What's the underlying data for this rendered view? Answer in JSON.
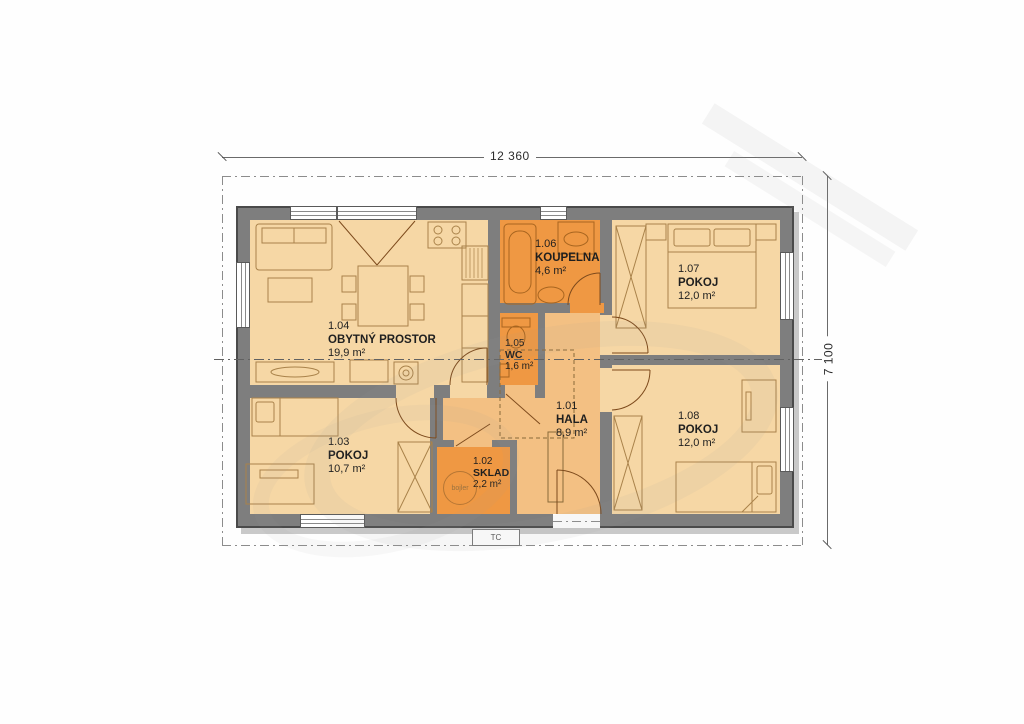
{
  "plan": {
    "dim_width": "12 360",
    "dim_height": "7 100",
    "rooms": {
      "hala": {
        "number": "1.01",
        "name": "HALA",
        "area": "8,9 m²"
      },
      "sklad": {
        "number": "1.02",
        "name": "SKLAD",
        "area": "2,2 m²"
      },
      "pokoj3": {
        "number": "1.03",
        "name": "POKOJ",
        "area": "10,7 m²"
      },
      "obytny": {
        "number": "1.04",
        "name": "OBYTNÝ PROSTOR",
        "area": "19,9 m²"
      },
      "wc": {
        "number": "1.05",
        "name": "WC",
        "area": "1,6 m²"
      },
      "koupelna": {
        "number": "1.06",
        "name": "KOUPELNA",
        "area": "4,6 m²"
      },
      "pokoj7": {
        "number": "1.07",
        "name": "POKOJ",
        "area": "12,0 m²"
      },
      "pokoj8": {
        "number": "1.08",
        "name": "POKOJ",
        "area": "12,0 m²"
      }
    },
    "equipment": {
      "boiler": "bojler",
      "heat_pump": "TC"
    },
    "colors": {
      "floor_room": "#f6d7a5",
      "floor_hall": "#f3c083",
      "floor_service": "#ef9843",
      "wall": "#7e7e7e"
    }
  }
}
